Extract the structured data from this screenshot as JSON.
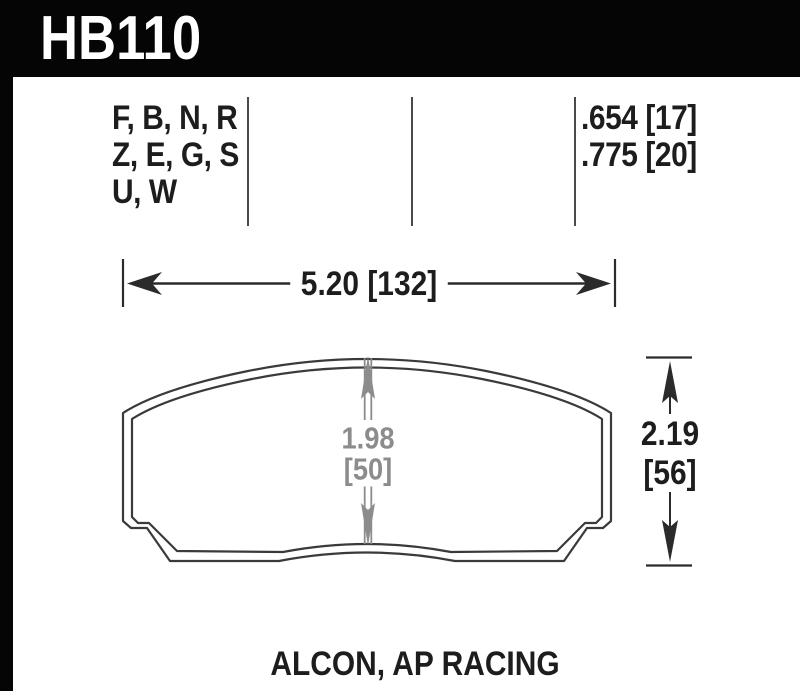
{
  "header": {
    "part_number": "HB110"
  },
  "spec": {
    "compounds": [
      "F, B, N, R",
      "Z, E, G, S",
      "U, W"
    ],
    "pad_thickness": [
      ".654 [17]",
      ".775 [20]"
    ]
  },
  "dims": {
    "width": "5.20 [132]",
    "overall_height_in": "2.19",
    "overall_height_mm": "[56]",
    "pad_height_in": "1.98",
    "pad_height_mm": "[50]"
  },
  "footer": {
    "applications": "ALCON, AP RACING"
  },
  "colors": {
    "header_bg": "#050505",
    "header_fg": "#ffffff",
    "text_black": "#1d1d1d",
    "outline_gray": "#3a3a3a",
    "dim_gray": "#8c8c8c",
    "divider_gray": "#4a4a4a"
  }
}
